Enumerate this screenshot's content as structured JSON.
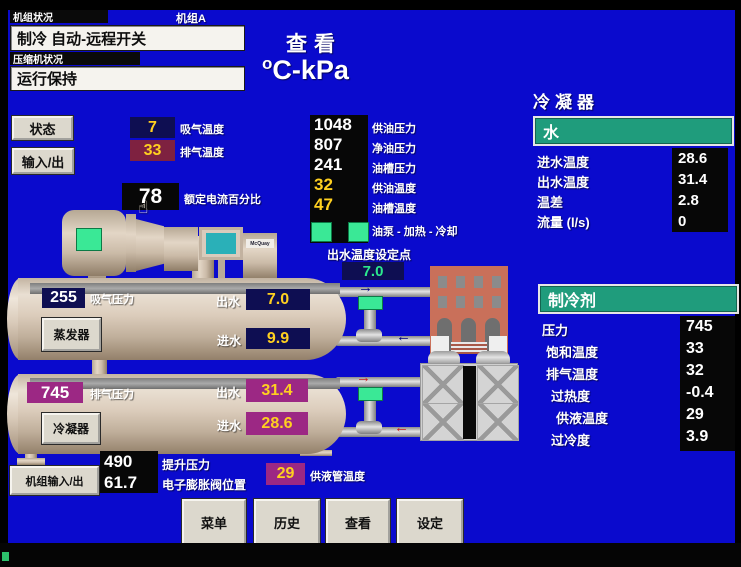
{
  "colors": {
    "screen_blue": "#0a0acd",
    "accent_teal": "#1f9c7c",
    "value_yellow": "#ffd020",
    "indicator_green": "#3ae896",
    "magenta_box": "#9c2884",
    "navy_box": "#0e0e52",
    "maroon_box": "#7e2140"
  },
  "icons": {
    "arrow_right": "→",
    "arrow_left": "←",
    "hand_cursor": "☝"
  },
  "brand": "McQuay",
  "header": {
    "unit_status_label": "机组状况",
    "unit_status_value": "制冷 自动-远程开关",
    "unit_name": "机组A",
    "compressor_status_label": "压缩机状况",
    "compressor_status_value": "运行保持",
    "view_title": "查看",
    "units_sup": "o",
    "units_main": "C-kPa"
  },
  "nav": {
    "status_button": "状态",
    "io_button": "输入/出",
    "unit_io_button": "机组输入/出",
    "bottom_buttons": [
      "菜单",
      "历史",
      "查看",
      "设定"
    ]
  },
  "compressor": {
    "suction_temp_value": "7",
    "suction_temp_label": "吸气温度",
    "discharge_temp_value": "33",
    "discharge_temp_label": "排气温度",
    "current_pct_value": "78",
    "current_pct_label": "额定电流百分比"
  },
  "oil": {
    "rows": [
      {
        "value": "1048",
        "label": "供油压力"
      },
      {
        "value": "807",
        "label": "净油压力"
      },
      {
        "value": "241",
        "label": "油槽压力"
      },
      {
        "value": "32",
        "label": "供油温度"
      },
      {
        "value": "47",
        "label": "油槽温度"
      }
    ],
    "pump_label": "油泵 - 加热 - 冷却"
  },
  "setpoint": {
    "label": "出水温度设定点",
    "value": "7.0"
  },
  "evaporator": {
    "pressure_value": "255",
    "pressure_label": "吸气压力",
    "button": "蒸发器",
    "leaving_label": "出水",
    "leaving_value": "7.0",
    "entering_label": "进水",
    "entering_value": "9.9"
  },
  "condenser_vessel": {
    "pressure_value": "745",
    "pressure_label": "排气压力",
    "button": "冷凝器",
    "leaving_label": "出水",
    "leaving_value": "31.4",
    "entering_label": "进水",
    "entering_value": "28.6"
  },
  "expansion": {
    "lift_pressure_value": "490",
    "lift_pressure_label": "提升压力",
    "eev_value": "61.7",
    "eev_label": "电子膨胀阀位置",
    "liquid_temp_value": "29",
    "liquid_temp_label": "供液管温度"
  },
  "condenser_panel": {
    "title": "冷凝器",
    "water_header": "水",
    "rows": [
      {
        "label": "进水温度",
        "value": "28.6"
      },
      {
        "label": "出水温度",
        "value": "31.4"
      },
      {
        "label": "温差",
        "value": "2.8"
      },
      {
        "label": "流量 (l/s)",
        "value": "0"
      }
    ]
  },
  "refrigerant_panel": {
    "header": "制冷剂",
    "rows": [
      {
        "label": "压力",
        "value": "745"
      },
      {
        "label": "饱和温度",
        "value": "33"
      },
      {
        "label": "排气温度",
        "value": "32"
      },
      {
        "label": "过热度",
        "value": "-0.4"
      },
      {
        "label": "供液温度",
        "value": "29"
      },
      {
        "label": "过冷度",
        "value": "3.9"
      }
    ]
  }
}
